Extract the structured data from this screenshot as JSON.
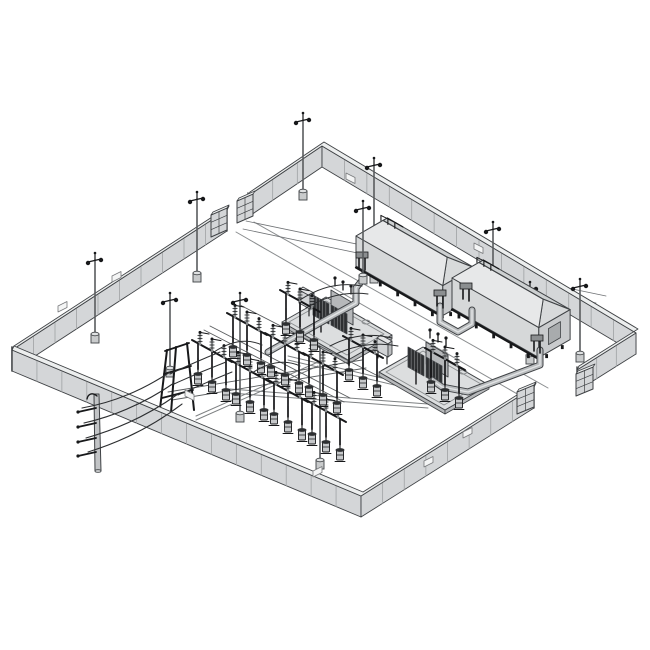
{
  "meta": {
    "alt_text": "Isometric line drawing of a fenced electrical substation yard with two enclosed transformer units, switchgear bays, light poles, transformer pads, bus ducts and an incoming overhead transmission pole",
    "background": "#ffffff"
  },
  "palette": {
    "line": "#3f4245",
    "thin": "#6f7275",
    "dark": "#17181a",
    "wall_face": "#d4d6d8",
    "wall_cap": "#eceeee",
    "wall_joint": "#9fa2a4",
    "vent_fill": "#f4f5f5",
    "concrete": "#c9cbcc",
    "concrete_top": "#e0e2e3",
    "enc_near": "#d6d8d9",
    "enc_end": "#c9cbcd",
    "enc_roof_near": "#e7e8e9",
    "enc_roof_far": "#cdd0d1",
    "enc_hip": "#d8dadb",
    "enc_door": "#a8abad",
    "pad_top": "#dcdedf",
    "pad_side": "#b7b9bb",
    "pad_line": "#8a8d8f",
    "duct_fill": "#b9bcbe",
    "duct_hi": "#e2e4e5",
    "tank": "#b6b8ba",
    "radiator": "#2e3032",
    "radiator_fin": "#7c7e80",
    "bottle": "#c6c8ca",
    "insulator": "#86898b",
    "road": "#8a8d8f",
    "wire": "#2c2e30",
    "rail": "#7d8082",
    "bus_line": "#595c5e",
    "pole_gray": "#c2c4c6"
  },
  "scene": {
    "roads": [
      [
        [
          236,
          232
        ],
        [
          526,
          399
        ]
      ],
      [
        [
          254,
          222
        ],
        [
          548,
          388
        ]
      ]
    ],
    "shield_wires": [
      [
        [
          246,
          221
        ],
        [
          606,
          296
        ]
      ],
      [
        [
          243,
          229
        ],
        [
          596,
          303
        ]
      ]
    ],
    "trenches": [
      [
        [
          196,
          416
        ],
        [
          318,
          362
        ]
      ],
      [
        [
          230,
          389
        ],
        [
          428,
          404
        ]
      ],
      [
        [
          288,
          356
        ],
        [
          424,
          388
        ]
      ]
    ],
    "walls": {
      "height": 21,
      "panel_spacing": 27,
      "back_runs": [
        {
          "name": "wall-north-east",
          "points": [
            [
              248,
              196
            ],
            [
              322,
              146
            ],
            [
              636,
              333
            ],
            [
              577,
              370
            ]
          ]
        },
        {
          "name": "wall-north-west",
          "points": [
            [
              227,
              210
            ],
            [
              12,
              350
            ]
          ]
        }
      ],
      "front_runs": [
        {
          "name": "wall-south-west-south-east",
          "points": [
            [
              12,
              350
            ],
            [
              361,
              496
            ],
            [
              534,
              387
            ]
          ]
        }
      ],
      "vents": [
        [
          58,
          306,
          -1
        ],
        [
          112,
          276,
          -1
        ],
        [
          185,
          390,
          1
        ],
        [
          346,
          173,
          1
        ],
        [
          474,
          243,
          1
        ],
        [
          463,
          432,
          -1
        ],
        [
          424,
          461,
          -1
        ],
        [
          313,
          471,
          -1
        ]
      ]
    },
    "gates": [
      {
        "x": 211,
        "y": 215,
        "w": 16,
        "slant": -7,
        "h": 22,
        "layer": "back"
      },
      {
        "x": 237,
        "y": 201,
        "w": 16,
        "slant": -7,
        "h": 22,
        "layer": "back"
      },
      {
        "x": 576,
        "y": 374,
        "w": 17,
        "slant": -7,
        "h": 22,
        "layer": "back"
      },
      {
        "x": 517,
        "y": 392,
        "w": 17,
        "slant": -7,
        "h": 22,
        "layer": "front"
      }
    ],
    "light_poles": [
      {
        "x": 303,
        "top": 117,
        "base": 199
      },
      {
        "x": 197,
        "top": 196,
        "base": 281
      },
      {
        "x": 95,
        "top": 257,
        "base": 342
      },
      {
        "x": 170,
        "top": 297,
        "base": 376
      },
      {
        "x": 374,
        "top": 162,
        "base": 282
      },
      {
        "x": 493,
        "top": 226,
        "base": 306
      },
      {
        "x": 580,
        "top": 283,
        "base": 361
      },
      {
        "x": 530,
        "top": 286,
        "base": 363
      },
      {
        "x": 240,
        "top": 297,
        "base": 421
      },
      {
        "x": 320,
        "top": 333,
        "base": 468
      },
      {
        "x": 363,
        "top": 205,
        "base": 283,
        "layer": "front"
      }
    ],
    "enclosures": [
      {
        "A": [
          356,
          266
        ],
        "L": 100,
        "D": 36,
        "H": 30,
        "rise": 13,
        "inset": 13
      },
      {
        "A": [
          452,
          308
        ],
        "L": 100,
        "D": 36,
        "H": 30,
        "rise": 13,
        "inset": 13
      }
    ],
    "pads": [
      {
        "outer": [
          [
            282,
            322
          ],
          [
            348,
            360
          ],
          [
            392,
            335
          ],
          [
            326,
            297
          ]
        ],
        "inner": [
          [
            289,
            322
          ],
          [
            347,
            355
          ],
          [
            384,
            334
          ],
          [
            326,
            301
          ]
        ],
        "hole": [
          366,
          322
        ]
      },
      {
        "outer": [
          [
            379,
            372
          ],
          [
            445,
            410
          ],
          [
            489,
            385
          ],
          [
            423,
            347
          ]
        ],
        "inner": [
          [
            386,
            372
          ],
          [
            444,
            405
          ],
          [
            481,
            384
          ],
          [
            423,
            351
          ]
        ],
        "hole": [
          463,
          372
        ]
      }
    ],
    "transformers": [
      [
        315,
        298
      ],
      [
        410,
        350
      ]
    ],
    "cabinets": [
      [
        299,
        290
      ],
      [
        377,
        338
      ]
    ],
    "ducts": [
      [
        [
          268,
          352
        ],
        [
          336,
          314
        ],
        [
          356,
          303
        ],
        [
          356,
          288
        ],
        [
          364,
          278
        ]
      ],
      [
        [
          440,
          306
        ],
        [
          440,
          322
        ],
        [
          458,
          332
        ],
        [
          472,
          324
        ],
        [
          472,
          310
        ]
      ],
      [
        [
          540,
          350
        ],
        [
          540,
          365
        ],
        [
          468,
          392
        ],
        [
          442,
          387
        ],
        [
          432,
          380
        ]
      ]
    ],
    "risers": [
      [
        362,
        268
      ],
      [
        440,
        306
      ],
      [
        466,
        299
      ],
      [
        537,
        351
      ]
    ],
    "switchgear": {
      "bays": [
        [
          212,
          352
        ],
        [
          250,
          372
        ],
        [
          288,
          392
        ],
        [
          326,
          412
        ],
        [
          247,
          325
        ],
        [
          285,
          345
        ],
        [
          323,
          365
        ],
        [
          300,
          302
        ],
        [
          363,
          348
        ],
        [
          445,
          360
        ]
      ],
      "aframe": {
        "legs": [
          [
            167,
            350,
            159,
            417
          ],
          [
            187,
            343,
            194,
            410
          ],
          [
            176,
            347,
            171,
            413
          ]
        ],
        "beams": [
          [
            165,
            351,
            189,
            343
          ],
          [
            164,
            374,
            191,
            366
          ],
          [
            162,
            398,
            193,
            390
          ]
        ]
      },
      "bus_lines": [
        [
          [
            168,
            392
          ],
          [
            362,
            360
          ]
        ],
        [
          [
            172,
            400
          ],
          [
            366,
            368
          ]
        ],
        [
          [
            204,
            330
          ],
          [
            344,
            402
          ]
        ],
        [
          [
            210,
            326
          ],
          [
            350,
            398
          ]
        ],
        [
          [
            240,
            305
          ],
          [
            380,
            377
          ]
        ]
      ],
      "jumpers": [
        [
          300,
          300,
          330,
          280,
          362,
          286
        ],
        [
          306,
          308,
          336,
          290,
          368,
          294
        ],
        [
          330,
          346,
          360,
          330,
          392,
          338
        ],
        [
          336,
          354,
          366,
          340,
          398,
          346
        ],
        [
          214,
          352,
          240,
          335,
          262,
          345
        ],
        [
          252,
          373,
          278,
          356,
          300,
          366
        ],
        [
          170,
          374,
          195,
          362,
          220,
          352
        ],
        [
          174,
          384,
          200,
          372,
          226,
          362
        ],
        [
          178,
          395,
          205,
          383,
          232,
          372
        ]
      ]
    },
    "transmission": {
      "pole": {
        "x": 97,
        "top": 394,
        "base": 471
      },
      "arms": [
        408,
        423,
        438,
        452
      ],
      "wires": [
        [
          82,
          408,
          128,
          400,
          170,
          372
        ],
        [
          84,
          423,
          132,
          412,
          174,
          383
        ],
        [
          86,
          438,
          136,
          424,
          178,
          394
        ],
        [
          88,
          452,
          140,
          436,
          182,
          404
        ]
      ]
    }
  }
}
